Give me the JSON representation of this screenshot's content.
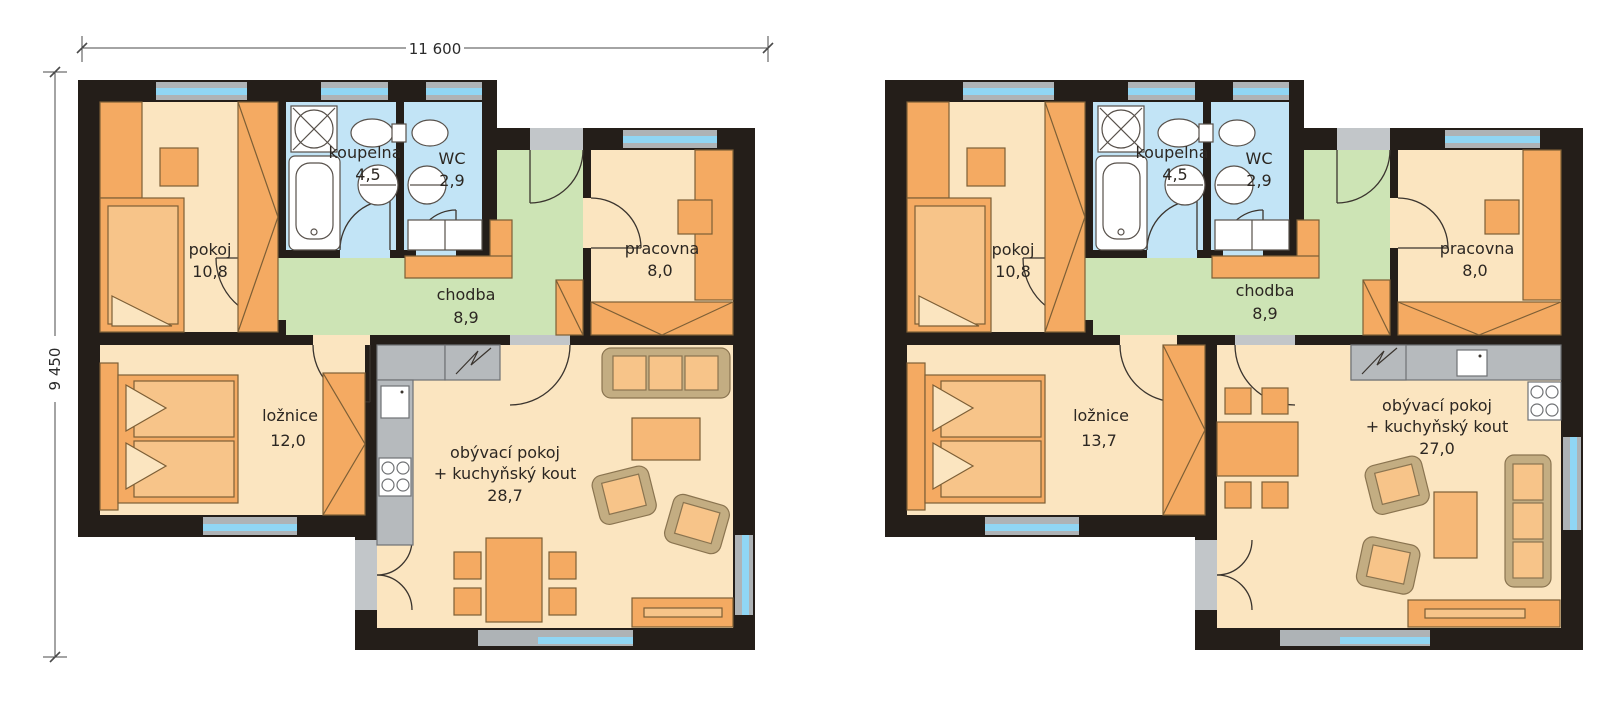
{
  "palette": {
    "wall": "#241e19",
    "floor_cream": "#fbe5c0",
    "furniture_orange": "#f4aa62",
    "furniture_light": "#f7c489",
    "corridor_green": "#cde4b5",
    "bath_blue": "#c2e4f6",
    "window_glass": "#90d6f4",
    "counter_gray": "#b6babd",
    "threshold_gray": "#c2c6c9",
    "sofa_tan": "#c3ad82",
    "background": "#ffffff"
  },
  "dimensions": {
    "width_label": "11 600",
    "height_label": "9 450"
  },
  "plans": [
    {
      "id": "left-variant",
      "rooms": {
        "pokoj": {
          "name": "pokoj",
          "area": "10,8"
        },
        "koupelna": {
          "name": "koupelna",
          "area": "4,5"
        },
        "wc": {
          "name": "WC",
          "area": "2,9"
        },
        "chodba": {
          "name": "chodba",
          "area": "8,9"
        },
        "pracovna": {
          "name": "pracovna",
          "area": "8,0"
        },
        "loznice": {
          "name": "ložnice",
          "area": "12,0"
        },
        "obyvaci": {
          "name_line1": "obývací pokoj",
          "name_line2": "+ kuchyňský kout",
          "area": "28,7"
        }
      }
    },
    {
      "id": "right-variant",
      "rooms": {
        "pokoj": {
          "name": "pokoj",
          "area": "10,8"
        },
        "koupelna": {
          "name": "koupelna",
          "area": "4,5"
        },
        "wc": {
          "name": "WC",
          "area": "2,9"
        },
        "chodba": {
          "name": "chodba",
          "area": "8,9"
        },
        "pracovna": {
          "name": "pracovna",
          "area": "8,0"
        },
        "loznice": {
          "name": "ložnice",
          "area": "13,7"
        },
        "obyvaci": {
          "name_line1": "obývací pokoj",
          "name_line2": "+ kuchyňský kout",
          "area": "27,0"
        }
      }
    }
  ]
}
